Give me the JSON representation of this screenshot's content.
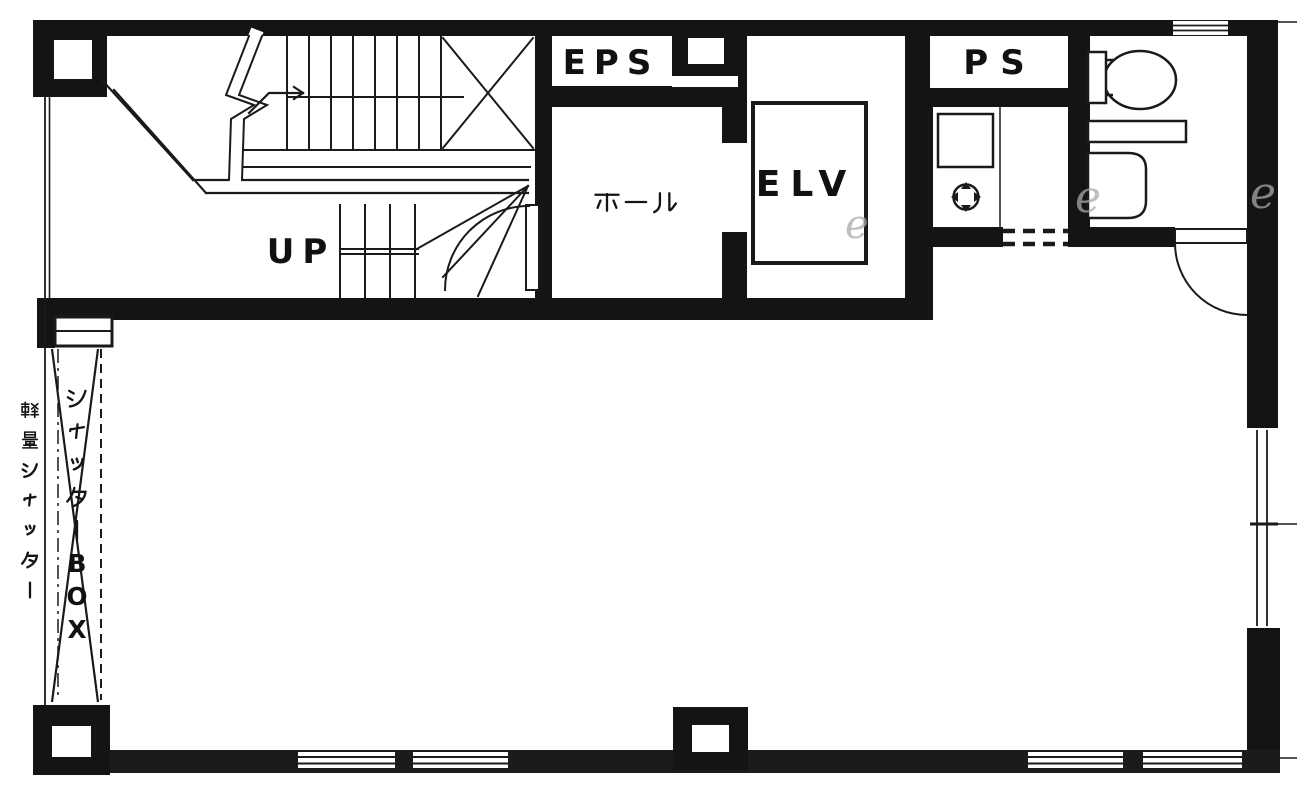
{
  "plan": {
    "colors": {
      "wall": "#141414",
      "wall_bottom": "#1b1b1b",
      "background": "#ffffff",
      "line": "#1a1a1a",
      "watermark": "#a9a9a9"
    },
    "rooms": [
      {
        "id": "staircase",
        "label": "UP"
      },
      {
        "id": "eps-shaft",
        "label": "EPS"
      },
      {
        "id": "hall",
        "label": "ホール"
      },
      {
        "id": "elevator",
        "label": "ELV"
      },
      {
        "id": "pipe-shaft",
        "label": "PS"
      },
      {
        "id": "toilet",
        "label": ""
      },
      {
        "id": "main-room",
        "label": ""
      }
    ],
    "annotations": {
      "shutter_box": "シャッターBOX",
      "lightweight_shutter": "軽量シャッター"
    },
    "watermark_letters": [
      "e",
      "e",
      "e"
    ]
  }
}
